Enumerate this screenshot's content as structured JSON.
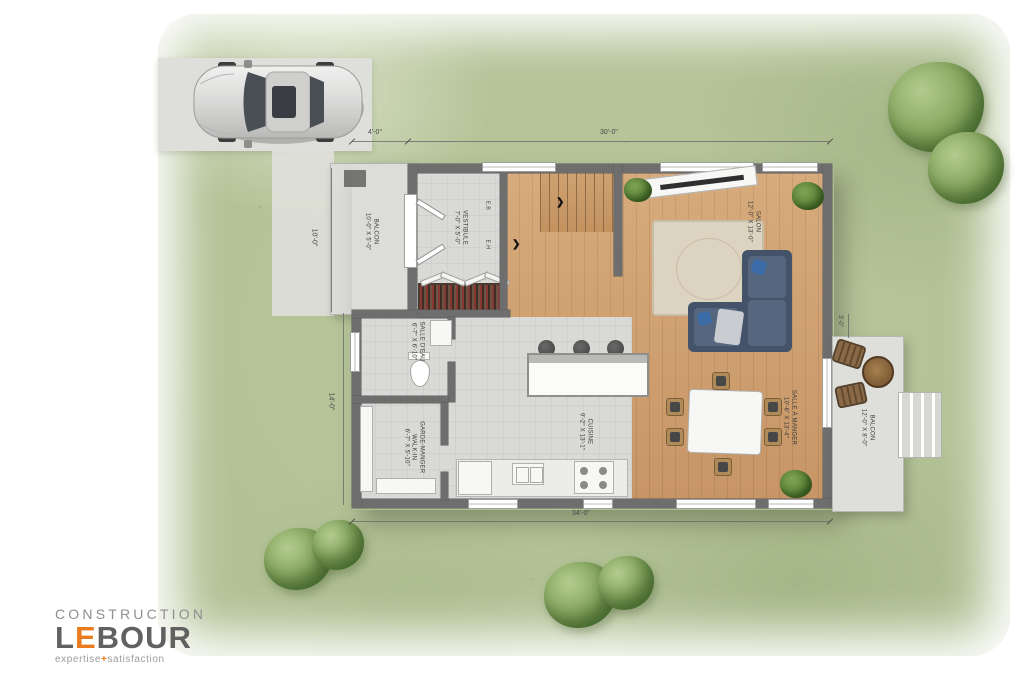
{
  "brand": {
    "top": "CONSTRUCTION",
    "name_l": "L",
    "name_e": "E",
    "name_rest": "BOUR",
    "tagline_left": "expertise",
    "tagline_plus": "+",
    "tagline_right": "satisfaction"
  },
  "rooms": {
    "vestibule": {
      "name": "VESTIBULE",
      "dims": "7'-0\" X 5'-0\""
    },
    "salon": {
      "name": "SALON",
      "dims": "12'-0\" X 13'-0\""
    },
    "cuisine": {
      "name": "CUISINE",
      "dims": "9'-2\" X 13'-1\""
    },
    "salle_a_manger": {
      "name": "SALLE À MANGER",
      "dims": "10'-6\" X 13'-4\""
    },
    "salle_eau": {
      "name": "SALLE D'EAU",
      "dims": "6'-7\" X 6'-10\""
    },
    "garde_manger": {
      "name": "GARDE-MANGER",
      "sub": "WALK-IN",
      "dims": "6'-7\" X 5'-10\""
    },
    "balcon_gauche": {
      "name": "BALCON",
      "dims": "10'-0\" X 5'-0\""
    },
    "balcon_droit": {
      "name": "BALCON",
      "dims": "12'-0\" X 8'-0\""
    }
  },
  "stairs": {
    "down_label": "E.B",
    "up_label": "E.H"
  },
  "icons": {
    "stair_arrow": "❯"
  },
  "dimensions": {
    "front_offset": "4'-0\"",
    "front_width": "30'-0\"",
    "side_upper": "10'-0\"",
    "side_lower": "14'-0\"",
    "rear_width": "34'-0\"",
    "balcony_side": "3'-0\""
  },
  "palette": {
    "accent_orange": "#E87C1F",
    "wall_gray": "#6E6E6E",
    "wood_floor": "#C99A6A",
    "lawn_green": "#AFC293",
    "concrete": "#D9D9D6"
  }
}
